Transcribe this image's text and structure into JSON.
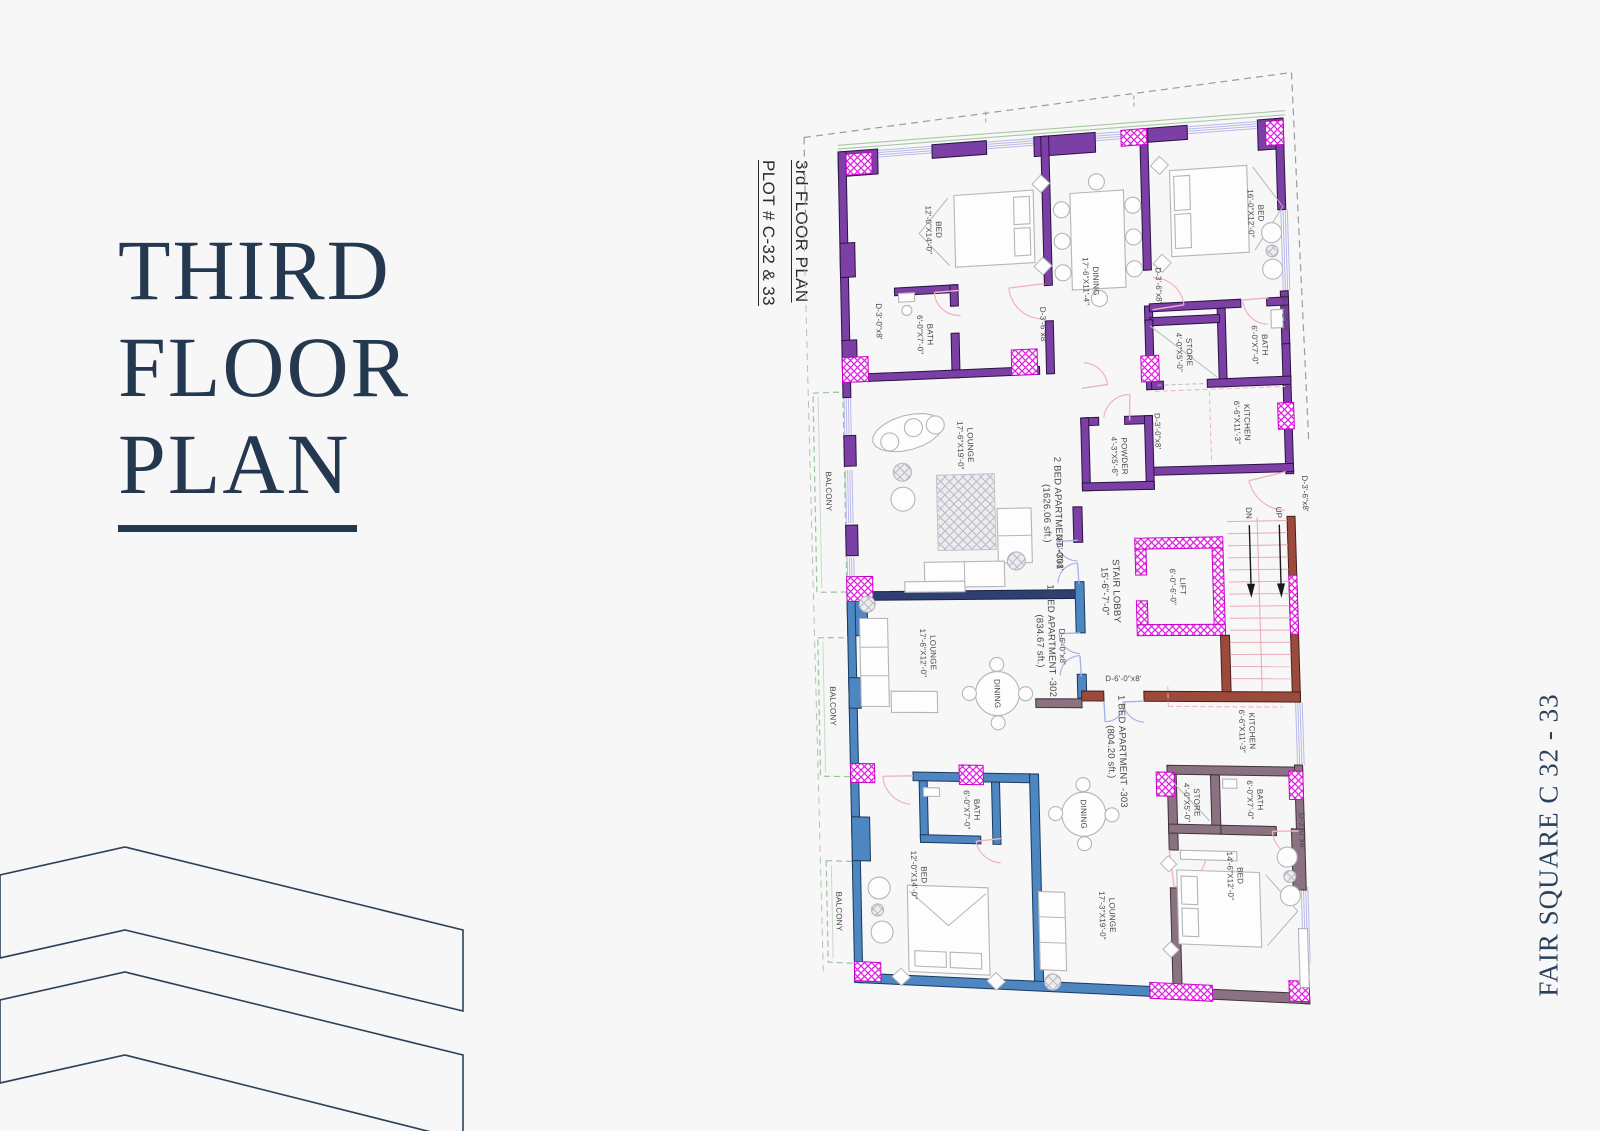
{
  "title": {
    "line1": "THIRD",
    "line2": "FLOOR",
    "line3": "PLAN"
  },
  "side_label": {
    "line1": "3rd FLOOR PLAN",
    "line2": "PLOT # C-32 & 33"
  },
  "brand_vertical": "FAIR SQUARE C 32 - 33",
  "colors": {
    "background": "#f7f7f8",
    "title_navy": "#24384f",
    "wall_purple": "#7b3fa5",
    "wall_blue": "#4d86c0",
    "wall_taupe": "#8b7280",
    "wall_maroon": "#9c4a3c",
    "wall_navy": "#2f3f70",
    "column_magenta": "#e01fe0",
    "window_lavender": "#b9b9ea",
    "door_pink": "#f0b3bf",
    "door_lightblue": "#aab3e6",
    "balcony_green": "#9cc49a",
    "furniture_gray": "#b5b5ba"
  },
  "plan": {
    "labels": [
      {
        "id": 0,
        "lines": [
          "BED",
          "12'-0\"X14'-0\""
        ],
        "x": 95,
        "y": 88
      },
      {
        "id": 1,
        "lines": [
          "BATH",
          "6'-0\"X7'-0\""
        ],
        "x": 84,
        "y": 196
      },
      {
        "id": 2,
        "lines": [
          "D-3'-0\"x8'"
        ],
        "x": 38,
        "y": 180
      },
      {
        "id": 3,
        "lines": [
          "D-3'-6\"x8'"
        ],
        "x": 203,
        "y": 192
      },
      {
        "id": 4,
        "lines": [
          "DINING",
          "17'-6\"X11'-4\""
        ],
        "x": 252,
        "y": 150
      },
      {
        "id": 5,
        "lines": [
          "D-3'-6\"x8'"
        ],
        "x": 320,
        "y": 158
      },
      {
        "id": 6,
        "lines": [
          "BED",
          "16'-0\"X12'-0\""
        ],
        "x": 420,
        "y": 92
      },
      {
        "id": 7,
        "lines": [
          "D-3'-0\"x8'"
        ],
        "x": 446,
        "y": 192
      },
      {
        "id": 8,
        "lines": [
          "BATH",
          "6'-0\"X7'-0\""
        ],
        "x": 420,
        "y": 222
      },
      {
        "id": 9,
        "lines": [
          "STORE",
          "4'-0\"X5'-0\""
        ],
        "x": 344,
        "y": 226
      },
      {
        "id": 10,
        "lines": [
          "KITCHEN",
          "6'-6\"X11'-3\""
        ],
        "x": 400,
        "y": 298
      },
      {
        "id": 11,
        "lines": [
          "D-3'-0\"x8'"
        ],
        "x": 315,
        "y": 304
      },
      {
        "id": 12,
        "lines": [
          "POWDER",
          "4'-3\"X5'-6\""
        ],
        "x": 276,
        "y": 328
      },
      {
        "id": 13,
        "lines": [
          "LOUNGE",
          "17'-6\"X19'-0\""
        ],
        "x": 122,
        "y": 312
      },
      {
        "id": 14,
        "lines": [
          "2 BED APARTMENT -301",
          "(1626.06 sft.)"
        ],
        "x": 208,
        "y": 384,
        "fs": 9.5
      },
      {
        "id": 15,
        "lines": [
          "BALCONY"
        ],
        "x": -16,
        "y": 356
      },
      {
        "id": 16,
        "lines": [
          "D-3'-6\"x8'"
        ],
        "x": 461,
        "y": 370
      },
      {
        "id": 17,
        "lines": [
          "STAIR LOBBY",
          "15'-6\"-7'-0\""
        ],
        "x": 264,
        "y": 464,
        "fs": 9.5
      },
      {
        "id": 18,
        "lines": [
          "LIFT",
          "6'-0\"-6'-0\""
        ],
        "x": 331,
        "y": 460
      },
      {
        "id": 19,
        "lines": [
          "DN"
        ],
        "x": 404,
        "y": 388
      },
      {
        "id": 20,
        "lines": [
          "UP"
        ],
        "x": 434,
        "y": 388
      },
      {
        "id": 21,
        "lines": [
          "D-6'-0\"x8'"
        ],
        "x": 214,
        "y": 424
      },
      {
        "id": 22,
        "lines": [
          "D-6'-0\"x8'"
        ],
        "x": 214,
        "y": 520
      },
      {
        "id": 23,
        "lines": [
          "D-6'-0\"x8'"
        ],
        "x": 274,
        "y": 552,
        "rot": 0
      },
      {
        "id": 24,
        "lines": [
          "LOUNGE",
          "17'-6\"X12'-0\""
        ],
        "x": 80,
        "y": 526
      },
      {
        "id": 25,
        "lines": [
          "DINING"
        ],
        "x": 148,
        "y": 568
      },
      {
        "id": 26,
        "lines": [
          "1 BED APARTMENT -302",
          "(834.67 sft.)"
        ],
        "x": 198,
        "y": 514,
        "fs": 9.5
      },
      {
        "id": 27,
        "lines": [
          "BALCONY"
        ],
        "x": -16,
        "y": 582
      },
      {
        "id": 28,
        "lines": [
          "BATH",
          "6'-0\"X7'-0\""
        ],
        "x": 120,
        "y": 688
      },
      {
        "id": 29,
        "lines": [
          "BED",
          "12'-0\"X14'-0\""
        ],
        "x": 66,
        "y": 757
      },
      {
        "id": 30,
        "lines": [
          "BALCONY"
        ],
        "x": -14,
        "y": 798
      },
      {
        "id": 31,
        "lines": [
          "1 BED APARTMENT -303",
          "(804.20 sft.)"
        ],
        "x": 266,
        "y": 626,
        "fs": 9.5
      },
      {
        "id": 32,
        "lines": [
          "KITCHEN",
          "6'-6\"X11'-3\""
        ],
        "x": 396,
        "y": 604
      },
      {
        "id": 33,
        "lines": [
          "STORE",
          "4'-0\"X5'-0\""
        ],
        "x": 339,
        "y": 676
      },
      {
        "id": 34,
        "lines": [
          "BATH",
          "6'-0\"X7'-0\""
        ],
        "x": 402,
        "y": 672
      },
      {
        "id": 35,
        "lines": [
          "D-3'-0\"x8'"
        ],
        "x": 448,
        "y": 702
      },
      {
        "id": 36,
        "lines": [
          "BED",
          "14'-6\"X12'-0\""
        ],
        "x": 380,
        "y": 748
      },
      {
        "id": 37,
        "lines": [
          "DINING"
        ],
        "x": 231,
        "y": 690
      },
      {
        "id": 38,
        "lines": [
          "LOUNGE",
          "17'-3\"X19'-0\""
        ],
        "x": 252,
        "y": 792
      }
    ]
  }
}
